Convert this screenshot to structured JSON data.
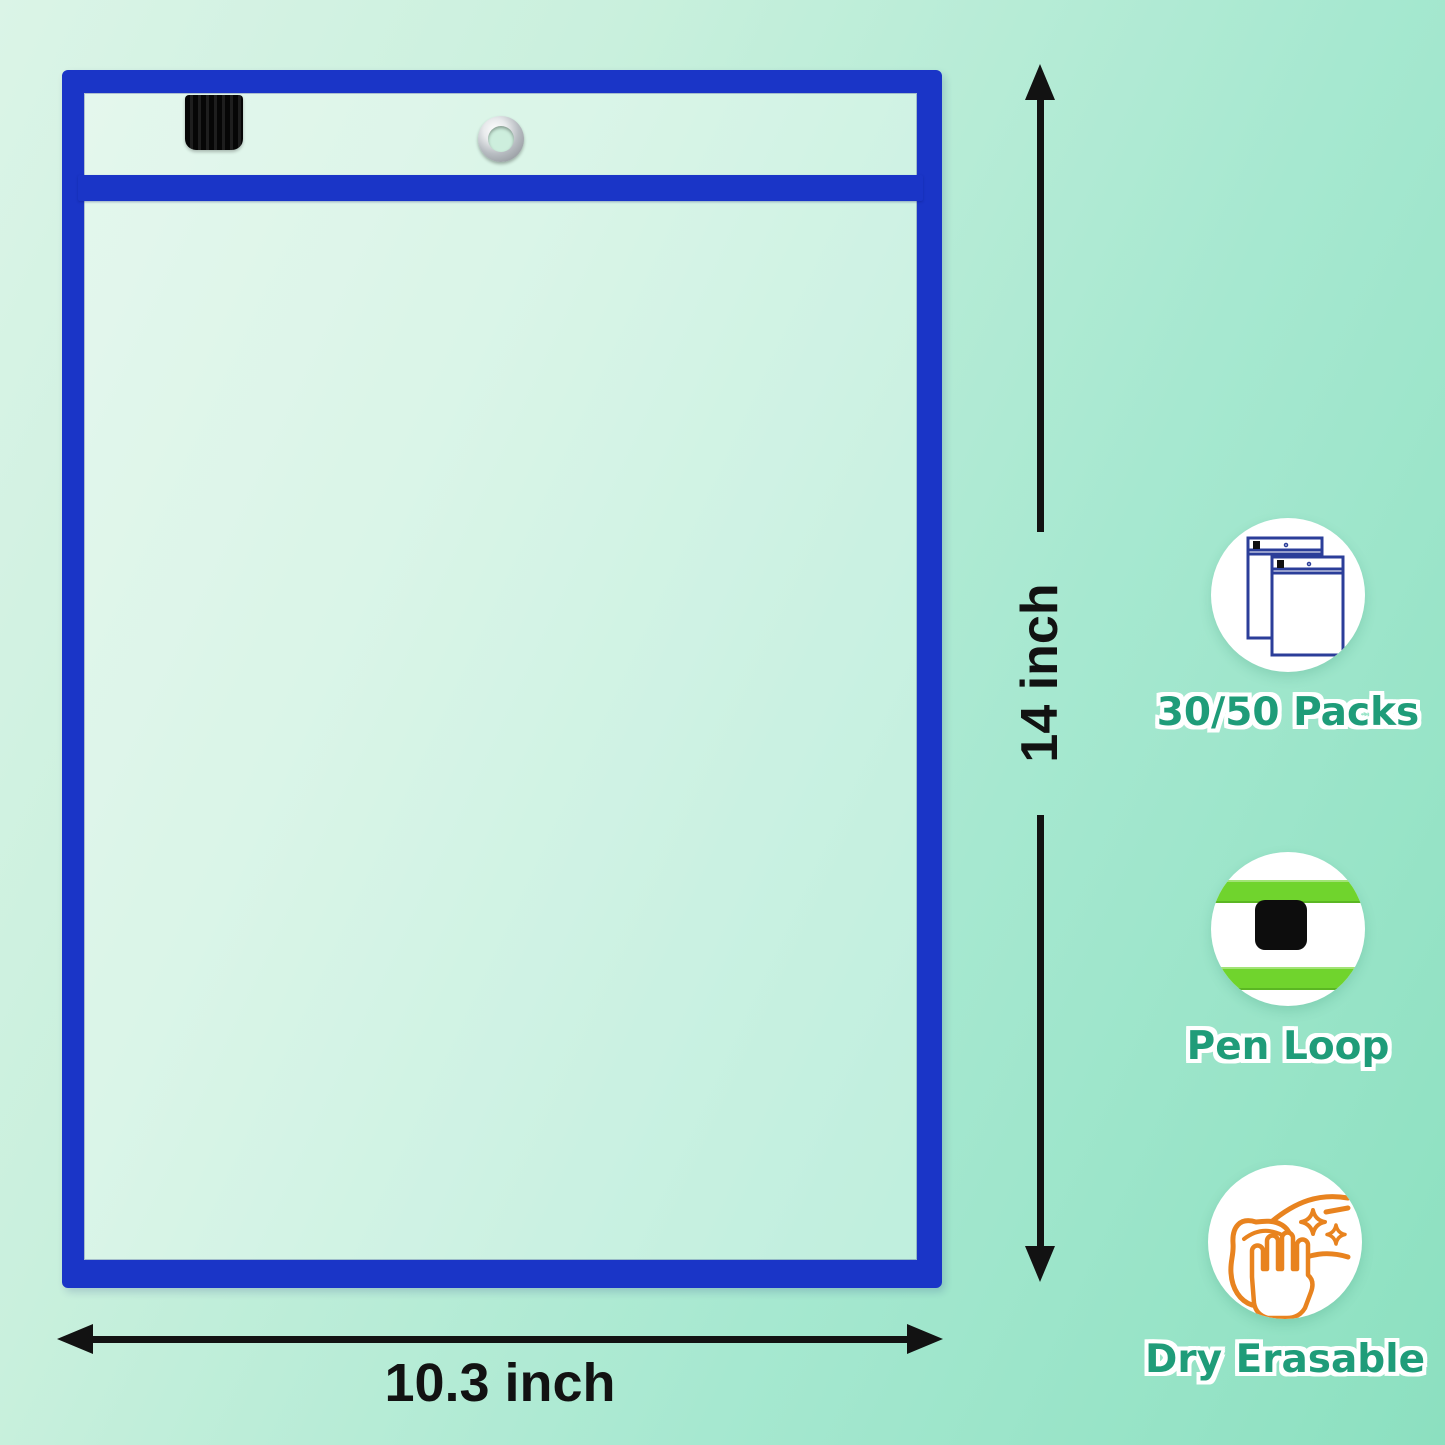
{
  "product": {
    "type": "dry-erase-pocket",
    "border_color": "#1a35c7",
    "pen_tab_color": "#0d0d0d",
    "grommet": "silver-eyelet"
  },
  "dimensions": {
    "height_label": "14 inch",
    "width_label": "10.3 inch"
  },
  "features": [
    {
      "label": "30/50 Packs",
      "icon": "pockets-stack-icon"
    },
    {
      "label": "Pen Loop",
      "icon": "pen-loop-icon"
    },
    {
      "label": "Dry Erasable",
      "icon": "wipe-hand-icon"
    }
  ],
  "colors": {
    "background_start": "#dbf4e7",
    "background_end": "#8ce0c0",
    "feature_label_green": "#1f9c79",
    "stripe_green": "#70d42d",
    "icon_navy": "#2b3e99",
    "icon_orange": "#e8831f",
    "dimension_black": "#121212"
  }
}
